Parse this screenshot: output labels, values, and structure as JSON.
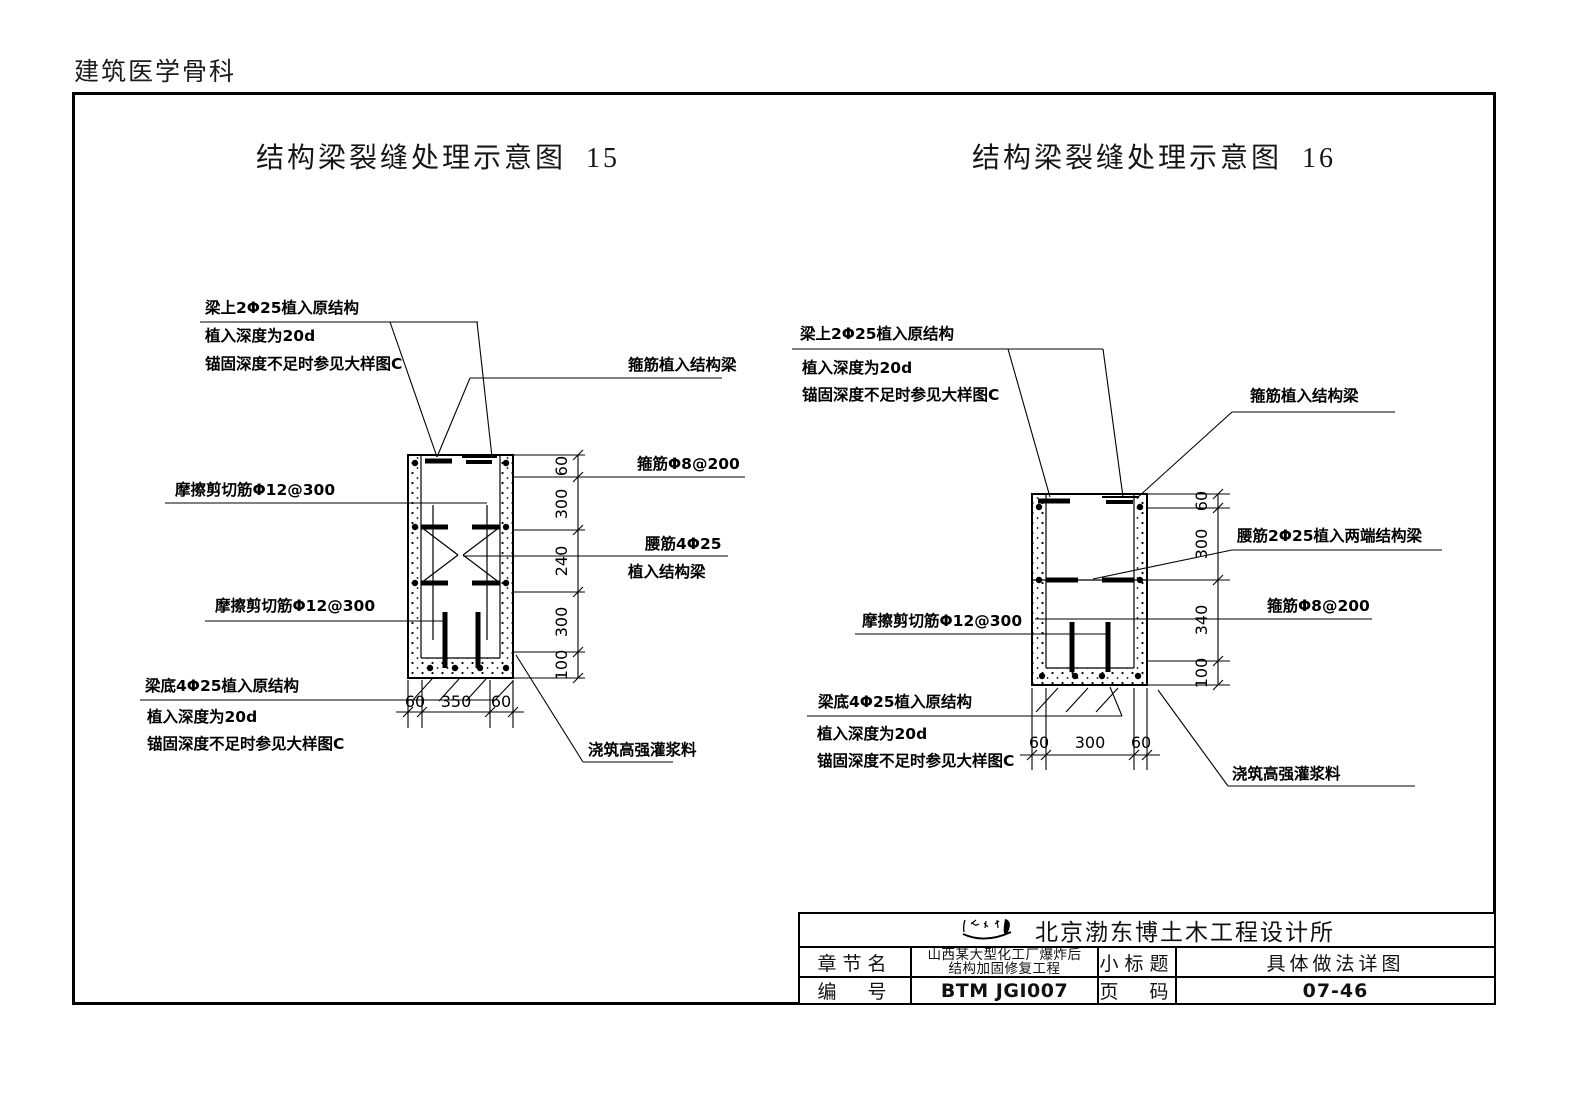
{
  "page": {
    "header": "建筑医学骨科"
  },
  "diagram15": {
    "title": "结构梁裂缝处理示意图  15",
    "labels": {
      "top_bar": "梁上2Φ25植入原结构",
      "top_depth": "植入深度为20d",
      "top_anchor": "锚固深度不足时参见大样图C",
      "stirrup_implant": "箍筋植入结构梁",
      "stirrup_spec": "箍筋Φ8@200",
      "waist_bar": "腰筋4Φ25",
      "waist_bar2": "植入结构梁",
      "friction_top": "摩擦剪切筋Φ12@300",
      "friction_bottom": "摩擦剪切筋Φ12@300",
      "bottom_bar": "梁底4Φ25植入原结构",
      "bottom_depth": "植入深度为20d",
      "bottom_anchor": "锚固深度不足时参见大样图C",
      "grout": "浇筑高强灌浆料"
    },
    "dims_right": [
      "60",
      "300",
      "240",
      "300",
      "100"
    ],
    "dims_bottom": [
      "60",
      "350",
      "60"
    ]
  },
  "diagram16": {
    "title": "结构梁裂缝处理示意图  16",
    "labels": {
      "top_bar": "梁上2Φ25植入原结构",
      "top_depth": "植入深度为20d",
      "top_anchor": "锚固深度不足时参见大样图C",
      "stirrup_implant": "箍筋植入结构梁",
      "waist_bar": "腰筋2Φ25植入两端结构梁",
      "stirrup_spec": "箍筋Φ8@200",
      "friction": "摩擦剪切筋Φ12@300",
      "bottom_bar": "梁底4Φ25植入原结构",
      "bottom_depth": "植入深度为20d",
      "bottom_anchor": "锚固深度不足时参见大样图C",
      "grout": "浇筑高强灌浆料"
    },
    "dims_right": [
      "60",
      "300",
      "340",
      "100"
    ],
    "dims_bottom": [
      "60",
      "300",
      "60"
    ]
  },
  "titleblock": {
    "company": "北京渤东博土木工程设计所",
    "chapter_label": "章节名",
    "project_line1": "山西某大型化工厂爆炸后",
    "project_line2": "结构加固修复工程",
    "subtitle_label": "小标题",
    "subtitle_value": "具体做法详图",
    "number_label": "编　号",
    "number_value": "BTM JGI007",
    "page_label": "页　码",
    "page_value": "07-46"
  }
}
